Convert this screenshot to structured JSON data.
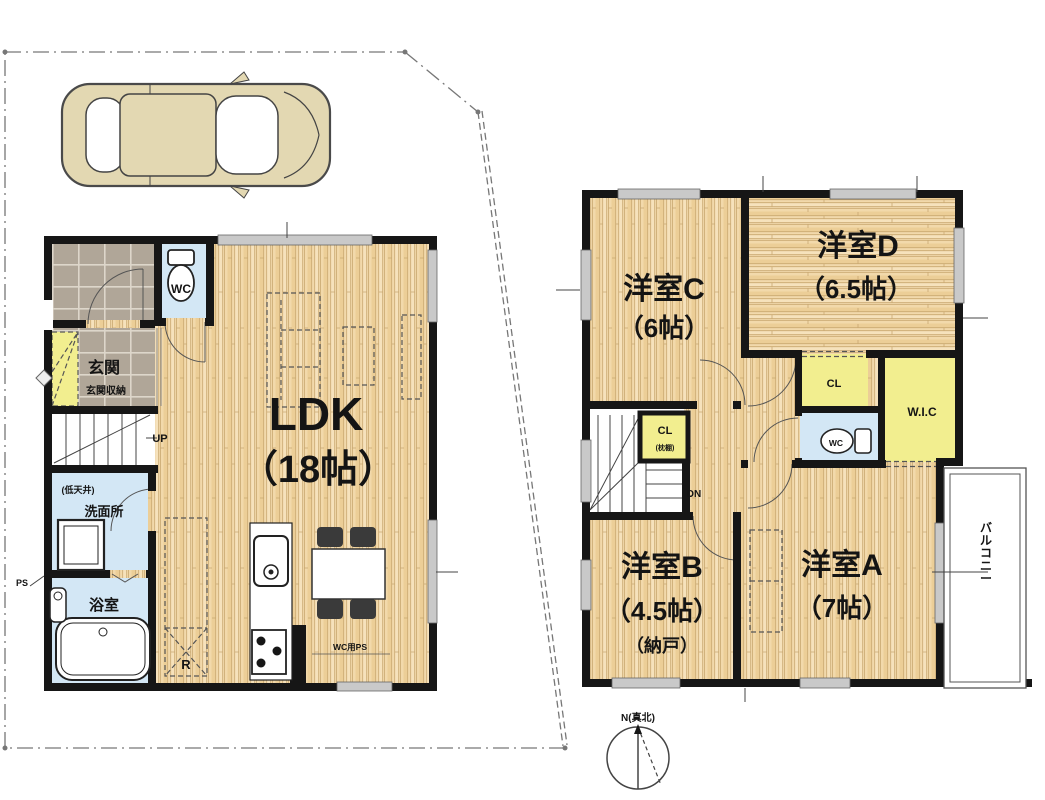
{
  "plan": {
    "first_floor": {
      "ldk": {
        "name": "LDK",
        "size": "（18帖）"
      },
      "entrance": {
        "name": "玄関",
        "storage": "玄関収納"
      },
      "toilet": {
        "name": "WC"
      },
      "stairs_up": {
        "name": "UP"
      },
      "washroom": {
        "name": "洗面所",
        "ceiling_note": "(低天井)"
      },
      "bathroom": {
        "name": "浴室"
      },
      "pipe_space": {
        "name": "PS"
      },
      "toilet_pipe_space": {
        "name": "WC用PS"
      },
      "refrigerator_space": {
        "name": "R"
      }
    },
    "second_floor": {
      "room_a": {
        "name": "洋室A",
        "size": "（7帖）"
      },
      "room_b": {
        "name": "洋室B",
        "size": "（4.5帖）",
        "note": "（納戸）"
      },
      "room_c": {
        "name": "洋室C",
        "size": "（6帖）"
      },
      "room_d": {
        "name": "洋室D",
        "size": "（6.5帖）"
      },
      "closet_d": {
        "name": "CL"
      },
      "hall_closet": {
        "name": "CL",
        "note": "(枕棚)"
      },
      "walk_in_closet": {
        "name": "W.I.C"
      },
      "toilet": {
        "name": "WC"
      },
      "stairs_down": {
        "name": "DN"
      },
      "balcony": {
        "name": "バルコニー"
      }
    },
    "compass": {
      "north_label": "N(真北)"
    },
    "colors": {
      "wall": "#161616",
      "wood": "#f2d9ab",
      "wood_grain": "#c9a870",
      "tile": "#b0a698",
      "wet_area": "#d3e7f5",
      "closet": "#f2ee8f",
      "window": "#c9c9c9",
      "car_body": "#e3d8b2",
      "boundary": "#777777",
      "background": "#ffffff"
    }
  }
}
